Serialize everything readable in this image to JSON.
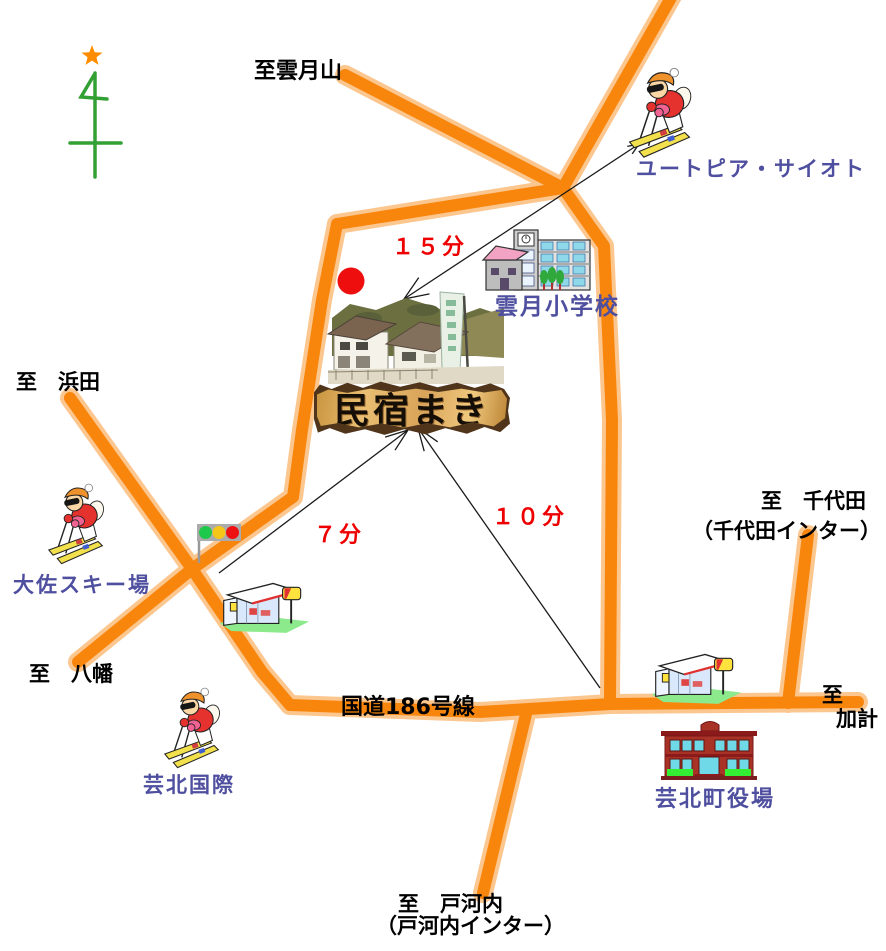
{
  "map": {
    "minshuku_banner": "民宿まき",
    "destinations": {
      "unzukiyama": "至雲月山",
      "hamada": "至　浜田",
      "yawata": "至　八幡",
      "chiyoda_line1": "至　千代田",
      "chiyoda_line2": "（千代田インター）",
      "kake_line1": "至",
      "kake_line2": "加計",
      "togouchi_line1": "至　戸河内",
      "togouchi_line2": "（戸河内インター）"
    },
    "roads": {
      "route186": "国道186号線"
    },
    "places": {
      "utopia_saioto": "ユートピア・サイオト",
      "unzuki_elementary_school": "雲月小学校",
      "osa_ski_resort": "大佐スキー場",
      "geihoku_kokusai": "芸北国際",
      "geihoku_town_hall": "芸北町役場"
    },
    "travel_times": {
      "utopia": "１５分",
      "osa": "７分",
      "town_hall": "１０分"
    },
    "icons": {
      "north_arrow": "north-arrow-icon",
      "star": "star-icon",
      "skier": "skier-icon",
      "school": "school-building-icon",
      "traffic_light": "traffic-light-icon",
      "convenience_store": "convenience-store-icon",
      "town_hall": "town-hall-icon",
      "location_dot": "red-location-dot",
      "photo": "minshuku-photo"
    },
    "colors": {
      "road_orange": "#F8860D",
      "road_halo": "#FCC083",
      "label_blue": "#4F4FA0",
      "label_red": "#EE0000",
      "label_black": "#000000",
      "compass_green": "#33A033",
      "star_orange": "#FF8C00",
      "dot_red": "#EE0E0E"
    }
  }
}
